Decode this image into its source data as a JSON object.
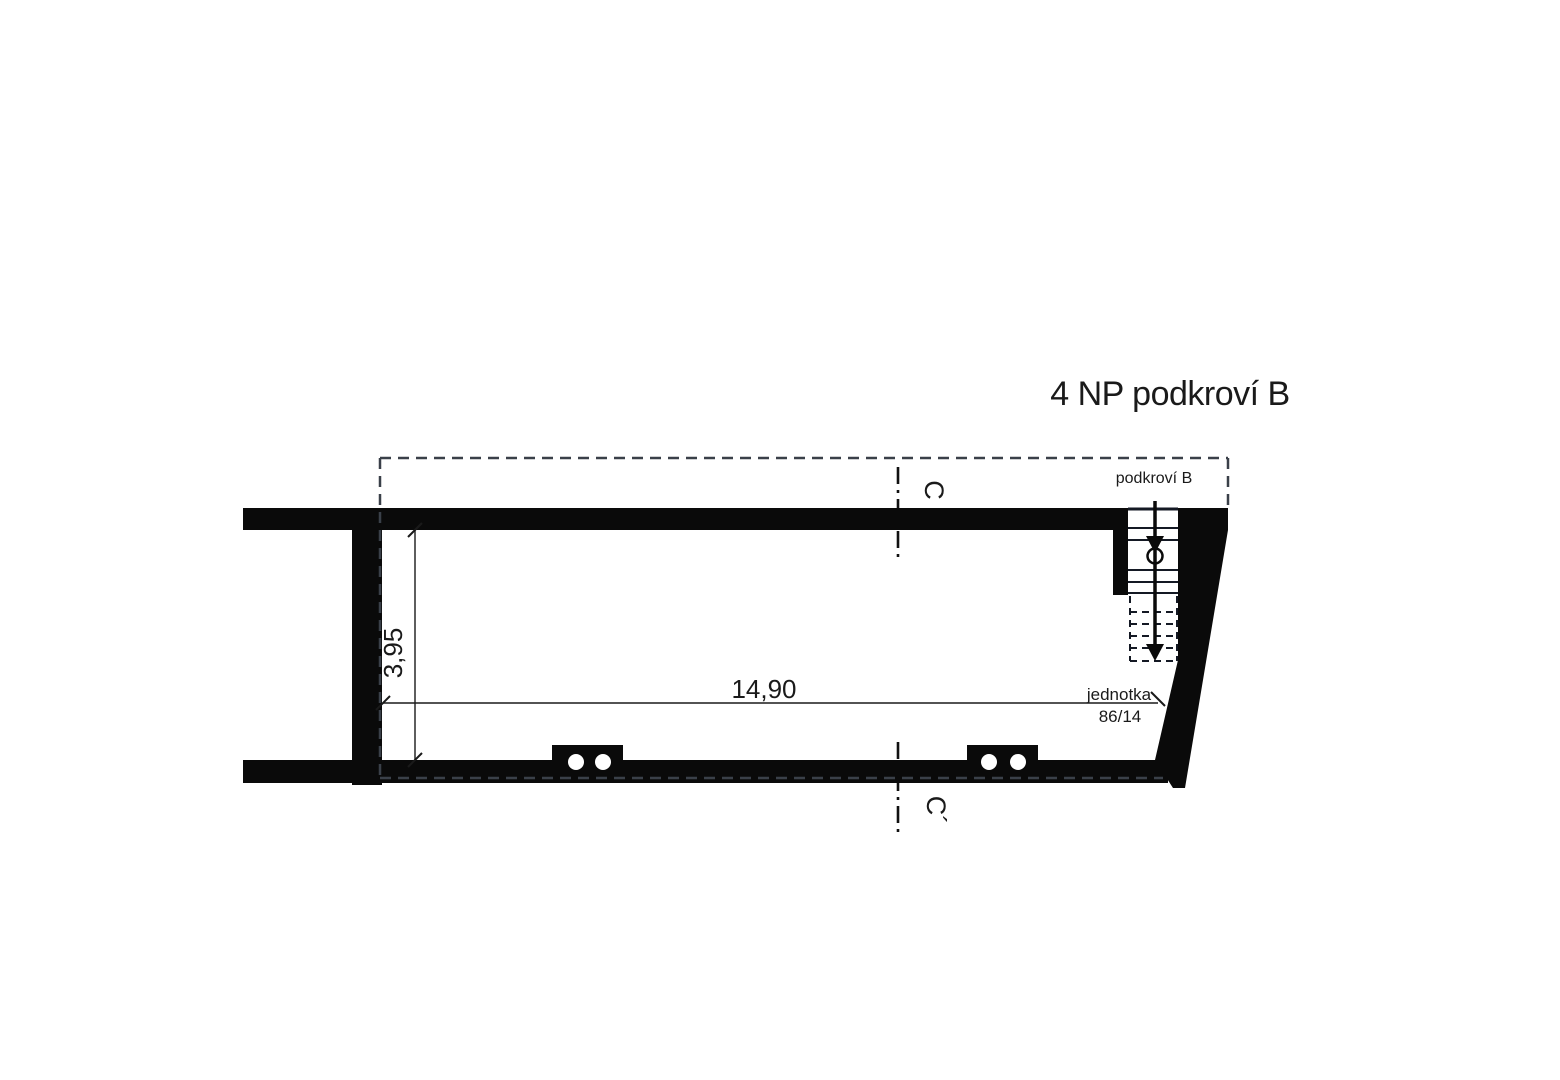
{
  "title": "4 NP podkroví B",
  "plan": {
    "area_label": "podkroví B",
    "unit": {
      "label": "jednotka",
      "number": "86/14"
    },
    "dimensions": {
      "room_width_m": "14,90",
      "room_depth_m": "3,95"
    },
    "section": {
      "top": "C",
      "bottom": "C´"
    }
  },
  "colors": {
    "wall": "#0a0a0a",
    "outline_dash": "#3a4049",
    "tread_line": "#141924",
    "text": "#1a1a1a",
    "background": "#ffffff"
  }
}
